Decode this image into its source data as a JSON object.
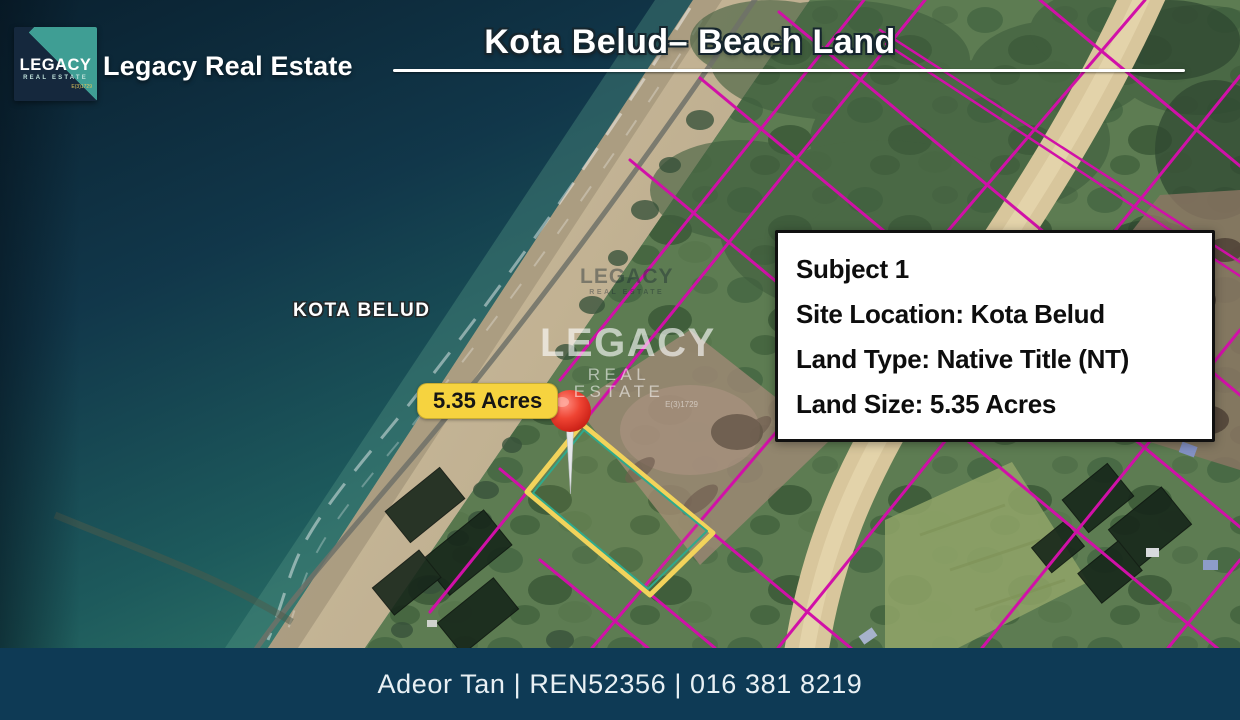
{
  "brand": {
    "logo_line1": "LEGACY",
    "logo_line2": "REAL ESTATE",
    "logo_micro": "E(3)1729",
    "name": "Legacy Real Estate"
  },
  "header": {
    "title": "Kota Belud– Beach Land"
  },
  "map": {
    "place_label": "KOTA BELUD",
    "area_badge": "5.35 Acres",
    "watermark_small": {
      "line1": "LEGACY",
      "line2": "REAL ESTATE"
    },
    "watermark": {
      "line1": "LEGACY",
      "line2": "REAL ESTATE",
      "license": "E(3)1729"
    }
  },
  "info_box": {
    "lines": [
      "Subject 1",
      "Site Location: Kota Belud",
      "Land Type: Native Title (NT)",
      "Land Size: 5.35 Acres"
    ]
  },
  "footer": {
    "text": "Adeor Tan | REN52356 | 016 381 8219"
  },
  "colors": {
    "lot_line_magenta": "#d110a8",
    "parcel_outline_yellow": "#f2d35b",
    "parcel_outline_teal": "#2fa98c",
    "badge_yellow": "#f6d33f",
    "footer_navy": "#0e3a55",
    "logo_teal": "#3f9e94",
    "logo_navy": "#15283d",
    "ocean_deep": "#0a2331",
    "pin_red": "#e0392b"
  }
}
